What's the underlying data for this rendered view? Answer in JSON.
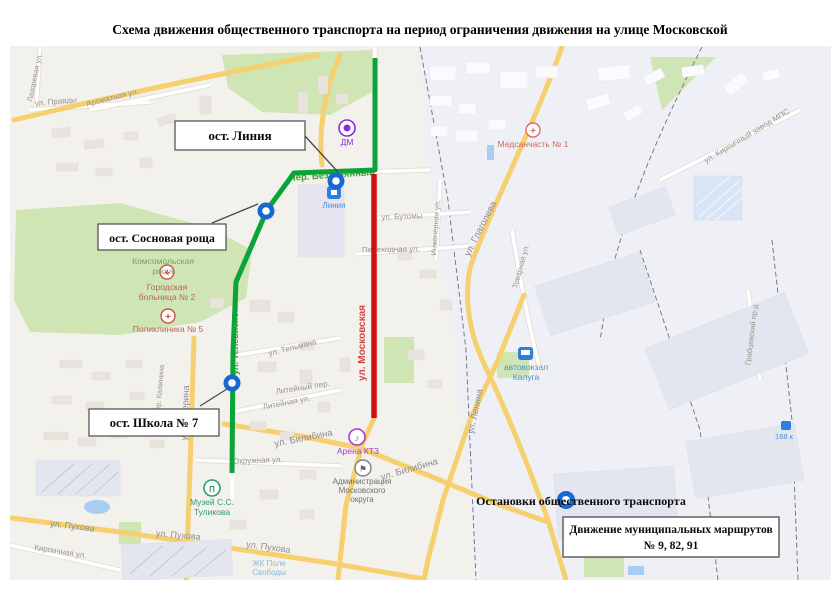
{
  "title": "Схема движения общественного транспорта на период ограничения движения на улице Московской",
  "routes": {
    "municipal_color": "#0ba33a",
    "restricted_color": "#cf1111",
    "stop_color": "#1569d2"
  },
  "callouts": {
    "liniya": "ост. Линия",
    "sosnovaya": "ост. Сосновая роща",
    "shkola": "ост. Школа № 7"
  },
  "legend": {
    "stops_label": "Остановки общественного транспорта",
    "routes_line1": "Движение муниципальных маршрутов",
    "routes_line2": "№ 9, 82, 91"
  },
  "streets": {
    "pravdy": "ул. Правды",
    "aromatnaya": "Ароматная ул.",
    "lazorevaya": "Лазоревая ул.",
    "kirpichny_zavod": "ул. Кирпичный завод МПС",
    "bezymyanny": "Пер. Безымянный",
    "butomy": "ул. Бутомы",
    "inzhenernaya": "Инженерная ул.",
    "perekhodnaya": "Переходная ул.",
    "glagoleva": "ул. Глаголева",
    "tovarnaya": "Товарная ул.",
    "televizionnaya": "ул. Телевизионная",
    "moskovskaya": "ул. Московская",
    "telmana": "ул. Тельмана",
    "liteyny_per": "Литейный пер.",
    "liteynaya": "Литейная ул.",
    "chicherina": "ул. Чичерина",
    "kalinina": "пер. Калинина",
    "okruzhnaya": "Окружная ул.",
    "bilibina1": "ул. Билибина",
    "bilibina2": "ул. Билибина",
    "pukhova1": "ул. Пухова",
    "pukhova2": "ул. Пухова",
    "pukhova3": "ул. Пухова",
    "kirpichnaya": "Кирпичная ул.",
    "lenina": "ул. Ленина",
    "grabtsevsky": "Грабцевский пр-д"
  },
  "pois": {
    "medsanchast": "Медсанчасть № 1",
    "dm": "ДМ",
    "liniya": "Линия",
    "hospital_line1": "Городская",
    "hospital_line2": "больница № 2",
    "poliklinika": "Поликлиника № 5",
    "roshcha_line1": "Комсомольская",
    "roshcha_line2": "роща",
    "arena": "Арена КТЗ",
    "admin_line1": "Администрация",
    "admin_line2": "Московского",
    "admin_line3": "округа",
    "avtovokzal_line1": "автовокзал",
    "avtovokzal_line2": "Калуга",
    "muzey_line1": "Музей С.С.",
    "muzey_line2": "Туликова",
    "zhk_line1": "ЖК Поле",
    "zhk_line2": "Свободы",
    "km168": "168 к"
  },
  "icons": {
    "medical_cross": "+",
    "music_note": "♪",
    "flag": "⚑",
    "museum": "П"
  }
}
